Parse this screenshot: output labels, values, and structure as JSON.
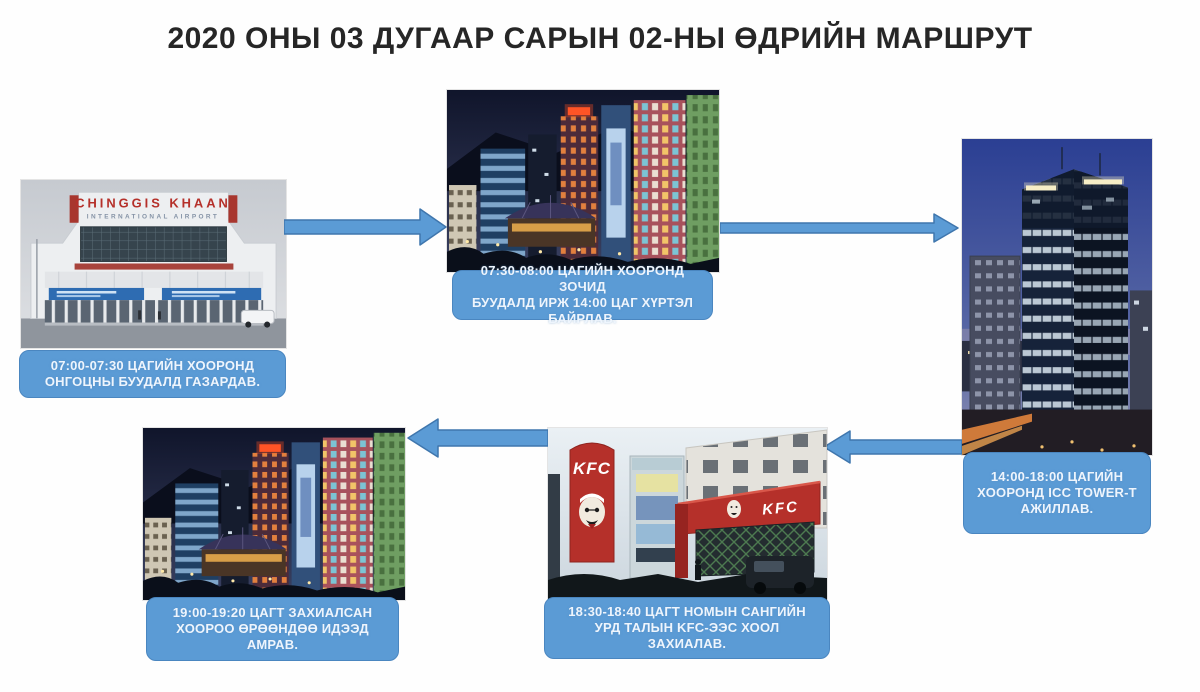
{
  "title": "2020 ОНЫ 03 ДУГААР САРЫН 02-НЫ ӨДРИЙН МАРШРУТ",
  "colors": {
    "caption_bg": "#5b9bd5",
    "caption_text": "#eef5fd",
    "arrow_fill": "#5b9bd5",
    "arrow_stroke": "#3f76ad",
    "title_text": "#262626",
    "page_bg": "#fefefe"
  },
  "steps": [
    {
      "caption": "07:00-07:30 ЦАГИЙН ХООРОНД\nОНГОЦНЫ БУУДАЛД ГАЗАРДАВ.",
      "photo": {
        "sign_line1": "CHINGGIS KHAAN",
        "sign_line2": "INTERNATIONAL AIRPORT"
      }
    },
    {
      "caption": "07:30-08:00 ЦАГИЙН ХООРОНД ЗОЧИД\nБУУДАЛД ИРЖ 14:00 ЦАГ ХҮРТЭЛ\nБАЙРЛАВ."
    },
    {
      "caption": "14:00-18:00 ЦАГИЙН\nХООРОНД ICC TOWER-Т\nАЖИЛЛАВ."
    },
    {
      "caption": "18:30-18:40 ЦАГТ НОМЫН САНГИЙН\nУРД ТАЛЫН KFC-ЭЭС ХООЛ\nЗАХИАЛАВ.",
      "photo": {
        "pylon_sign": "KFC",
        "awning_sign": "KFC"
      }
    },
    {
      "caption": "19:00-19:20 ЦАГТ ЗАХИАЛСАН\nХООРОО ӨРӨӨНДӨӨ ИДЭЭД\nАМРАВ."
    }
  ]
}
